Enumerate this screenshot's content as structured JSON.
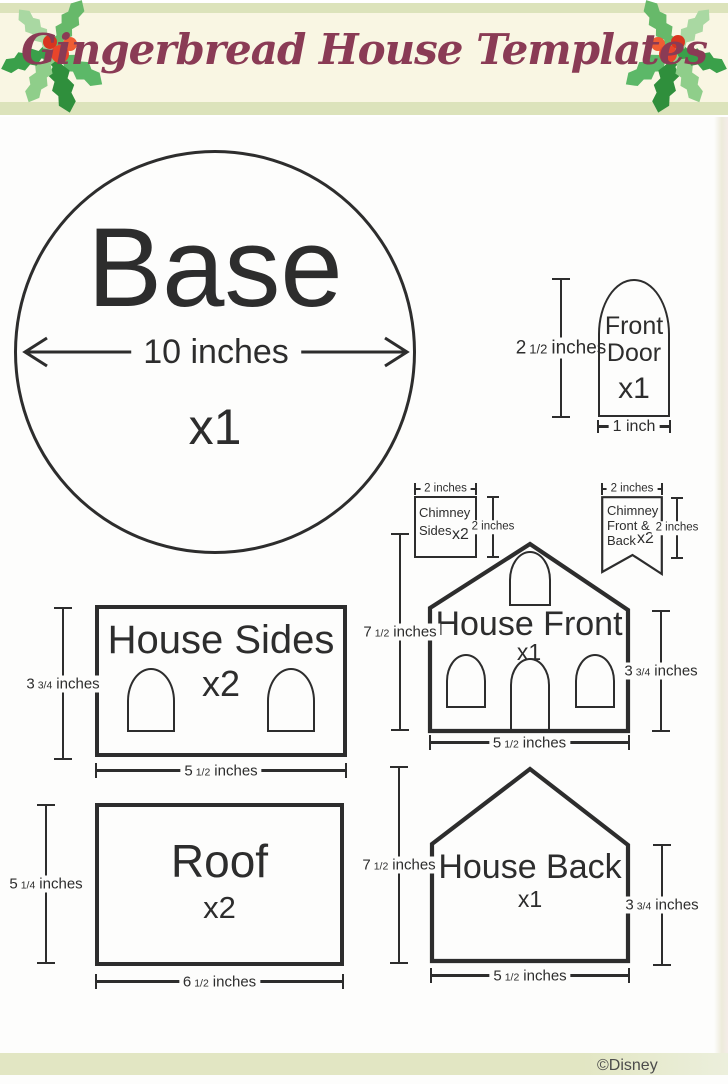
{
  "header": {
    "title": "Gingerbread House Templates"
  },
  "footer": {
    "copyright": "©Disney"
  },
  "colors": {
    "banner_cream": "#f9f6e3",
    "stripe_green": "#dce3bb",
    "title_maroon": "#8a3b55",
    "outline": "#2d2d2d",
    "berry_red": "#e8452b",
    "leaf_green": "#3f9e4d"
  },
  "pieces": {
    "base": {
      "label": "Base",
      "qty": "x1",
      "diameter": "10 inches"
    },
    "front_door": {
      "line1": "Front",
      "line2": "Door",
      "qty": "x1",
      "height": {
        "whole": "2",
        "frac": "1/2",
        "unit": "inches"
      },
      "width": "1 inch"
    },
    "chimney_sides": {
      "line1": "Chimney",
      "line2": "Sides",
      "qty": "x2",
      "width": "2 inches",
      "height": "2 inches"
    },
    "chimney_front_back": {
      "line1": "Chimney",
      "line2": "Front &",
      "line3": "Back",
      "qty": "x2",
      "width": "2 inches",
      "height": "2 inches"
    },
    "house_front": {
      "label": "House Front",
      "qty": "x1",
      "height": {
        "whole": "7",
        "frac": "1/2",
        "unit": "inches"
      },
      "side_height": {
        "whole": "3",
        "frac": "3/4",
        "unit": "inches"
      },
      "width": {
        "whole": "5",
        "frac": "1/2",
        "unit": "inches"
      }
    },
    "house_sides": {
      "label": "House Sides",
      "qty": "x2",
      "side_height": {
        "whole": "3",
        "frac": "3/4",
        "unit": "inches"
      },
      "width": {
        "whole": "5",
        "frac": "1/2",
        "unit": "inches"
      }
    },
    "roof": {
      "label": "Roof",
      "qty": "x2",
      "height": {
        "whole": "5",
        "frac": "1/4",
        "unit": "inches"
      },
      "width": {
        "whole": "6",
        "frac": "1/2",
        "unit": "inches"
      }
    },
    "house_back": {
      "label": "House Back",
      "qty": "x1",
      "height": {
        "whole": "7",
        "frac": "1/2",
        "unit": "inches"
      },
      "side_height": {
        "whole": "3",
        "frac": "3/4",
        "unit": "inches"
      },
      "width": {
        "whole": "5",
        "frac": "1/2",
        "unit": "inches"
      }
    }
  }
}
